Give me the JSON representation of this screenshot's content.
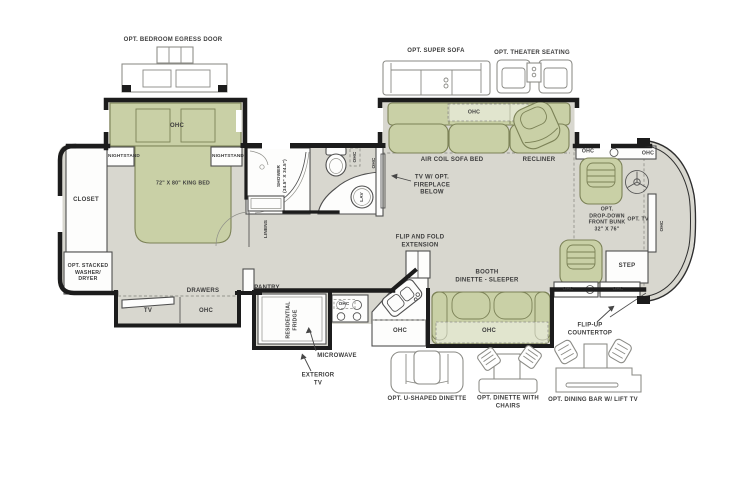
{
  "colors": {
    "floor": "#d8d7cf",
    "furniture": "#c9d0a6",
    "furniture_line": "#7c8257",
    "wall": "#1c1c1c",
    "line": "#4f4f4f",
    "opt_line": "#8a8a85",
    "text": "#3c3c3c",
    "white": "#fdfdfc"
  },
  "labels": {
    "egress_door": "OPT. BEDROOM EGRESS DOOR",
    "super_sofa": "OPT. SUPER SOFA",
    "theater_seating": "OPT. THEATER SEATING",
    "ohc": "OHC",
    "nightstand": "NIGHTSTAND",
    "king_bed": "72\" X 80\" KING BED",
    "closet": "CLOSET",
    "washer_dryer": "OPT. STACKED\nWASHER/\nDRYER",
    "tv": "TV",
    "drawers": "DRAWERS",
    "pantry": "PANTRY",
    "linens": "LINENS",
    "shower": "SHOWER\n(34.5\" X 34.5\")",
    "lav": "LAV",
    "tv_fireplace": "TV W/ OPT.\nFIREPLACE\nBELOW",
    "air_coil_sofa_bed": "AIR COIL SOFA BED",
    "recliner": "RECLINER",
    "front_bunk": "OPT.\nDROP-DOWN\nFRONT BUNK\n32\" X 76\"",
    "opt_tv": "OPT. TV",
    "step": "STEP",
    "flip_up_countertop": "FLIP-UP\nCOUNTERTOP",
    "residential_fridge": "RESIDENTIAL\nFRIDGE",
    "microwave": "MICROWAVE",
    "exterior_tv": "EXTERIOR\nTV",
    "flip_and_fold": "FLIP AND FOLD\nEXTENSION",
    "booth_dinette": "BOOTH\nDINETTE - SLEEPER",
    "u_shaped_dinette": "OPT. U-SHAPED DINETTE",
    "dinette_with_chairs": "OPT. DINETTE WITH\nCHAIRS",
    "dining_bar": "OPT. DINING BAR W/ LIFT TV"
  }
}
